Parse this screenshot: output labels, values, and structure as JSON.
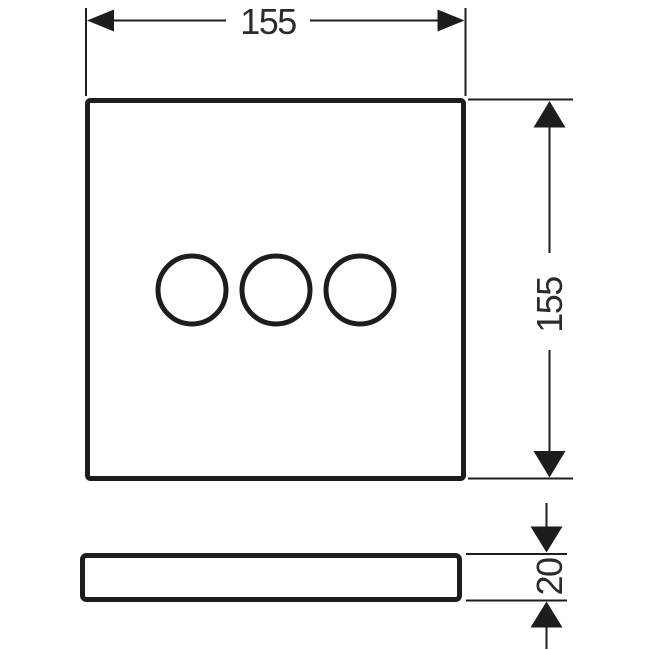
{
  "drawing": {
    "background_color": "#ffffff",
    "line_color": "#1d1d1b",
    "text_color": "#2b2b29",
    "dimensions": {
      "width": {
        "label": "155"
      },
      "height": {
        "label": "155"
      },
      "thickness": {
        "label": "20"
      }
    },
    "front_view": {
      "shape": "square-plate",
      "circle_count": 3
    },
    "side_view": {
      "shape": "slim-plate-profile"
    }
  }
}
